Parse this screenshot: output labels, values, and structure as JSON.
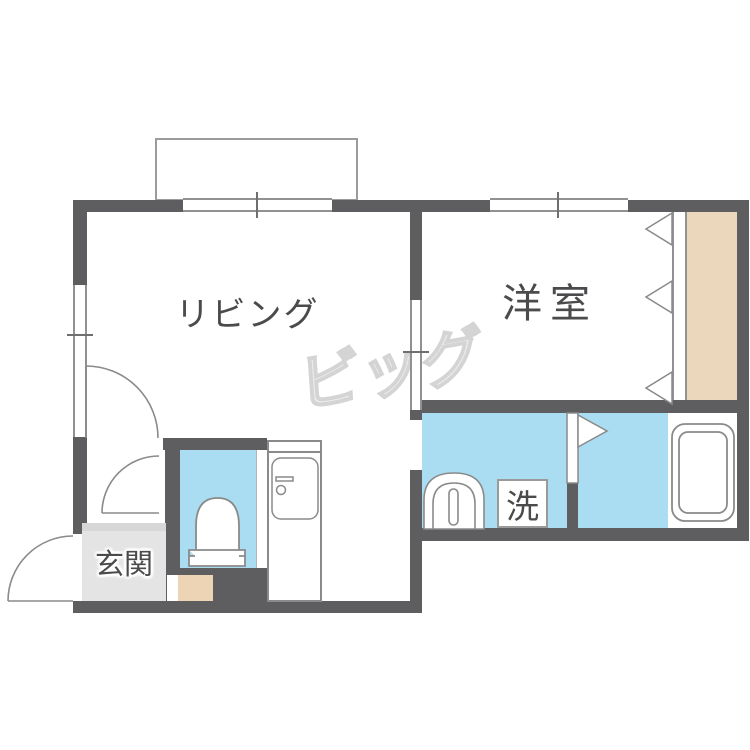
{
  "floorplan": {
    "type": "japanese-apartment-floor-plan",
    "rooms": {
      "living": {
        "label": "リビング"
      },
      "western_room": {
        "label": "洋室"
      },
      "entrance": {
        "label": "玄関"
      },
      "laundry": {
        "label": "洗"
      }
    },
    "watermark": {
      "text": "ビッグ"
    },
    "fixtures": [
      "toilet",
      "kitchen-sink",
      "washbasin",
      "bathtub",
      "washing-machine-space",
      "closet",
      "balcony"
    ],
    "colors": {
      "wall": "#5e5e60",
      "water_area": "#aadcf2",
      "closet": "#ebd7bc",
      "entrance_floor": "#e4e4e4",
      "entrance_step": "#d7d7d7",
      "wood_step": "#ecd4b4",
      "line": "#8a8a8a",
      "text": "#4b4b4d",
      "watermark": "#dcdcdc"
    }
  }
}
